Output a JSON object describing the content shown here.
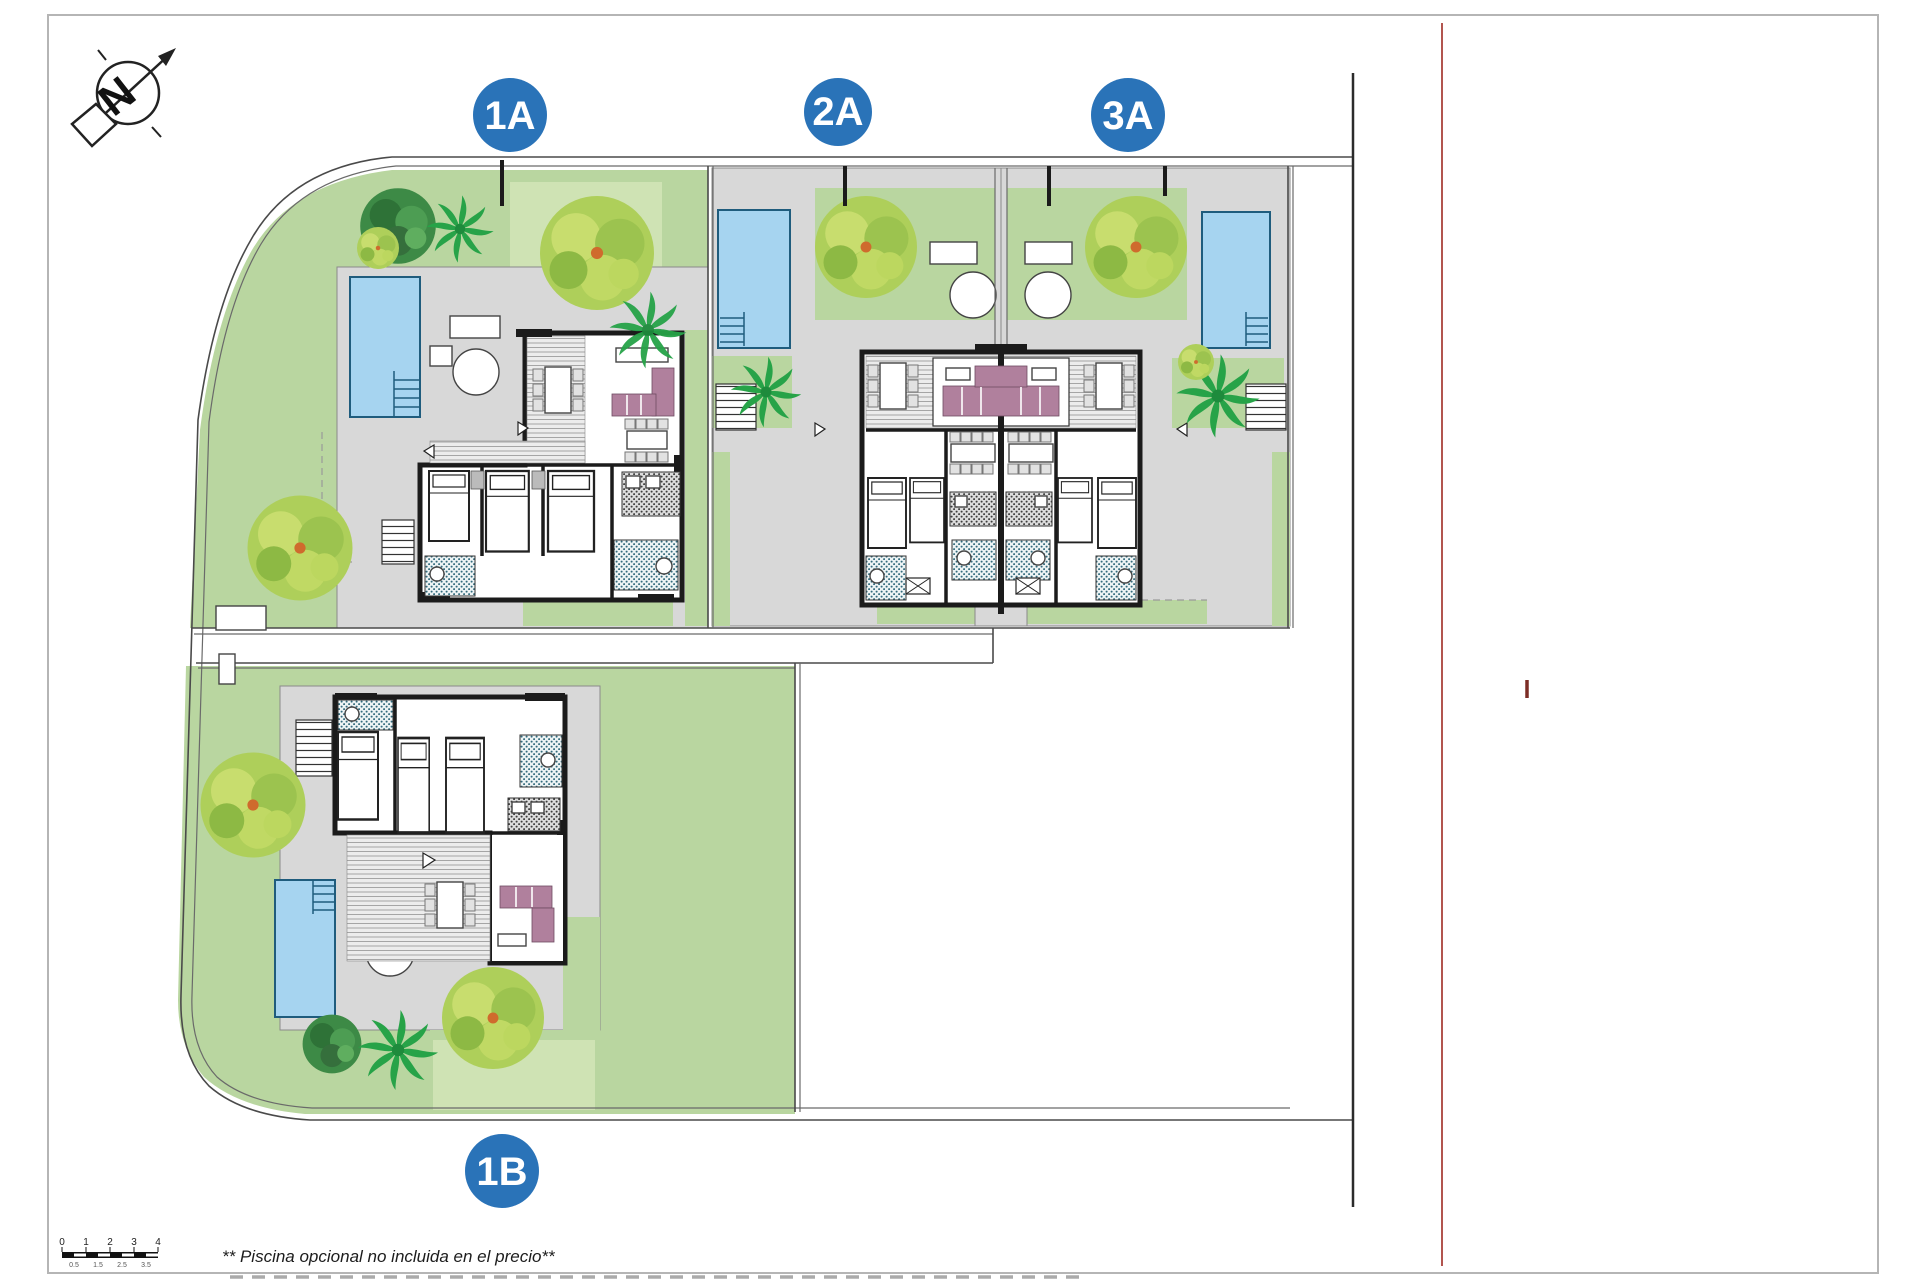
{
  "plan": {
    "compass": {
      "letter": "N"
    },
    "badges": [
      {
        "id": "1A"
      },
      {
        "id": "2A"
      },
      {
        "id": "3A"
      },
      {
        "id": "1B"
      }
    ],
    "caption": "** Piscina opcional no incluida en el precio**",
    "scalebar": {
      "labels": [
        "0",
        "1",
        "2",
        "3",
        "4"
      ],
      "sublabels": [
        "0.5",
        "1.5",
        "2.5",
        "3.5"
      ]
    },
    "colors": {
      "badge_blue": "#2a73b8",
      "lawn_green": "#b9d6a0",
      "patio_gray": "#d8d8d8",
      "pool_blue": "#a6d4f0",
      "wall_black": "#1b1b1b",
      "sofa_mauve": "#b0809d",
      "red_reference_line": "#b2554f",
      "bath_teal": "#336b7d"
    }
  }
}
